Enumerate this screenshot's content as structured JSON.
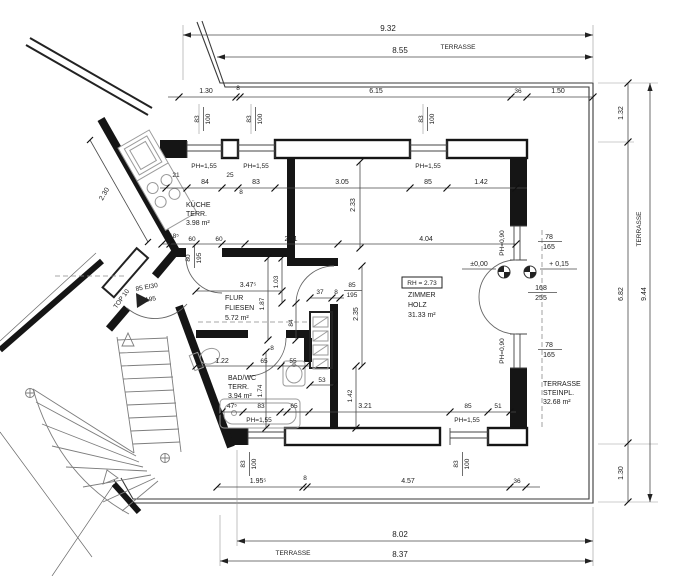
{
  "plan": {
    "rooms": {
      "kueche": {
        "name": "KÜCHE",
        "sub": "TERR.",
        "area": "3.98 m²"
      },
      "flur": {
        "name": "FLUR",
        "sub": "FLIESEN",
        "area": "5.72 m²"
      },
      "bad": {
        "name": "BAD/WC",
        "sub": "TERR.",
        "area": "3.94 m²"
      },
      "zimmer": {
        "name": "ZIMMER",
        "sub": "HOLZ",
        "area": "31.33 m²",
        "rh": "RH = 2.73"
      },
      "terrasse": {
        "name": "TERRASSE",
        "sub": "STEINPL.",
        "area": "32.68 m²"
      }
    },
    "levels": {
      "zero": "±0,00",
      "plus": "+ 0,15"
    },
    "entrance": {
      "door": "85 EI30",
      "height": "195",
      "unit": "TOP 10"
    },
    "dims": {
      "d932": "9.32",
      "d855": "8.55",
      "terrasse": "TERRASSE",
      "d130": "1.30",
      "d8": "8",
      "d615": "6.15",
      "d36": "36",
      "d150": "1.50",
      "brh_w": "83",
      "brh_h": "100",
      "ph155": "PH=1,55",
      "ph090": "PH=0,90",
      "d21": "21",
      "d84": "84",
      "d25": "25",
      "d83": "83",
      "d305": "3.05",
      "d85": "85",
      "d142": "1.42",
      "d233": "2.33",
      "d185": "18⁵",
      "d60": "60",
      "d211": "2.11",
      "d404": "4.04",
      "d78": "78",
      "d165": "165",
      "d168": "168",
      "d255": "255",
      "d80": "80",
      "d195": "195",
      "d3475": "3.47⁵",
      "d103": "1.03",
      "d187": "1.87",
      "d37": "37",
      "d235": "2.35",
      "d122": "1.22",
      "d65": "65",
      "d55": "55",
      "d174": "1.74",
      "d53": "53",
      "d475": "47⁵",
      "d321": "3.21",
      "d51": "51",
      "d1955": "1.95⁵",
      "d457": "4.57",
      "d802": "8.02",
      "d837": "8.37",
      "d132": "1.32",
      "d682": "6.82",
      "d944": "9.44",
      "d230": "2.30"
    }
  }
}
